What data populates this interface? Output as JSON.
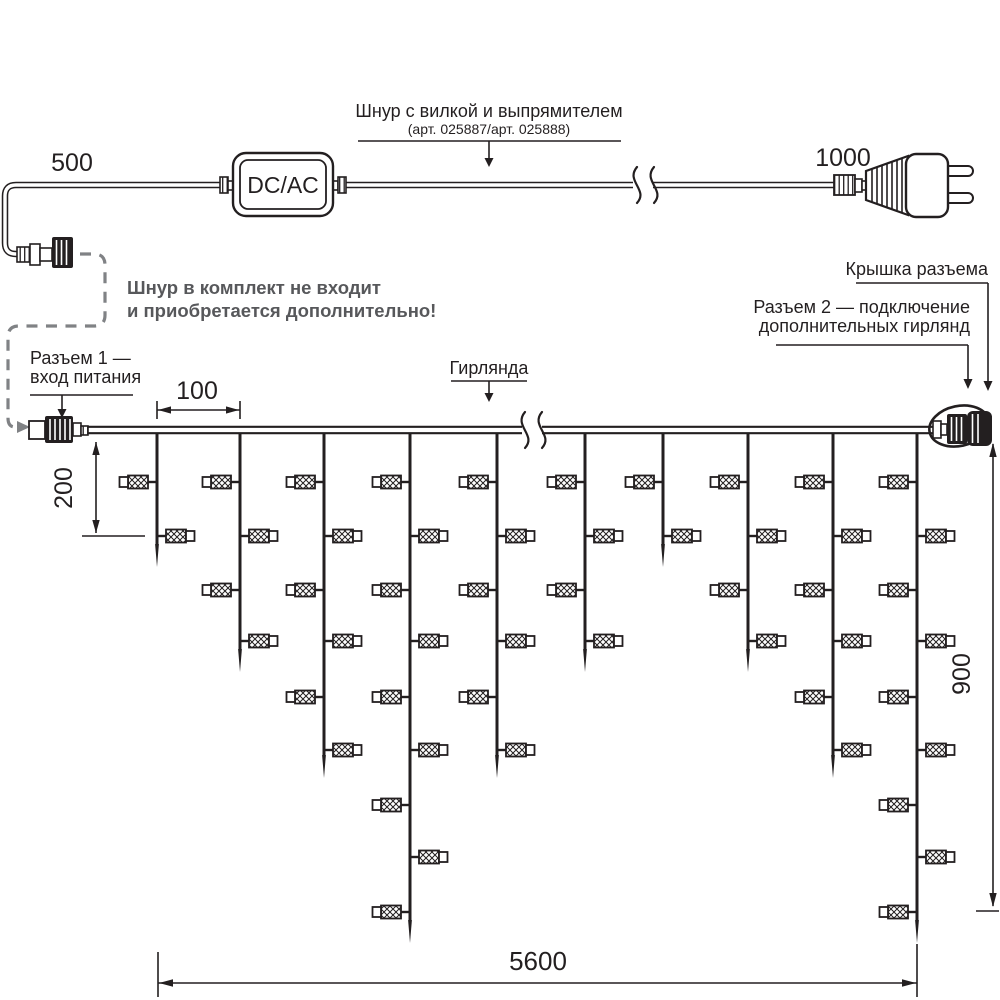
{
  "labels": {
    "dcac": "DC/AC",
    "cord_callout_line1": "Шнур с вилкой и выпрямителем",
    "cord_callout_line2": "(арт. 025887/арт. 025888)",
    "note_line1": "Шнур в комплект не входит",
    "note_line2": "и приобретается дополнительно!",
    "connector1_line1": "Разъем 1 —",
    "connector1_line2": "вход питания",
    "garland": "Гирлянда",
    "cap": "Крышка разъема",
    "connector2_line1": "Разъем 2 — подключение",
    "connector2_line2": "дополнительных гирлянд"
  },
  "dimensions": {
    "cord_left": "500",
    "cord_right": "1000",
    "drop_spacing": "100",
    "first_drop_height": "200",
    "garland_height": "900",
    "garland_length": "5600"
  },
  "colors": {
    "ink": "#231f20",
    "note_gray": "#57585b",
    "dash_gray": "#808285",
    "background": "#ffffff"
  },
  "diagram": {
    "type": "technical-diagram",
    "wire_y": 430,
    "bulb_rows_y": [
      482,
      536,
      590,
      641,
      697,
      750,
      805,
      857,
      912
    ],
    "drops": [
      {
        "x": 157,
        "bulbs": 2,
        "tip_y": 567
      },
      {
        "x": 240,
        "bulbs": 4,
        "tip_y": 672
      },
      {
        "x": 324,
        "bulbs": 6,
        "tip_y": 778
      },
      {
        "x": 410,
        "bulbs": 9,
        "tip_y": 943
      },
      {
        "x": 497,
        "bulbs": 6,
        "tip_y": 778
      },
      {
        "x": 585,
        "bulbs": 4,
        "tip_y": 672
      },
      {
        "x": 663,
        "bulbs": 2,
        "tip_y": 567
      },
      {
        "x": 748,
        "bulbs": 4,
        "tip_y": 672
      },
      {
        "x": 833,
        "bulbs": 6,
        "tip_y": 778
      },
      {
        "x": 917,
        "bulbs": 9,
        "tip_y": 943
      }
    ]
  }
}
